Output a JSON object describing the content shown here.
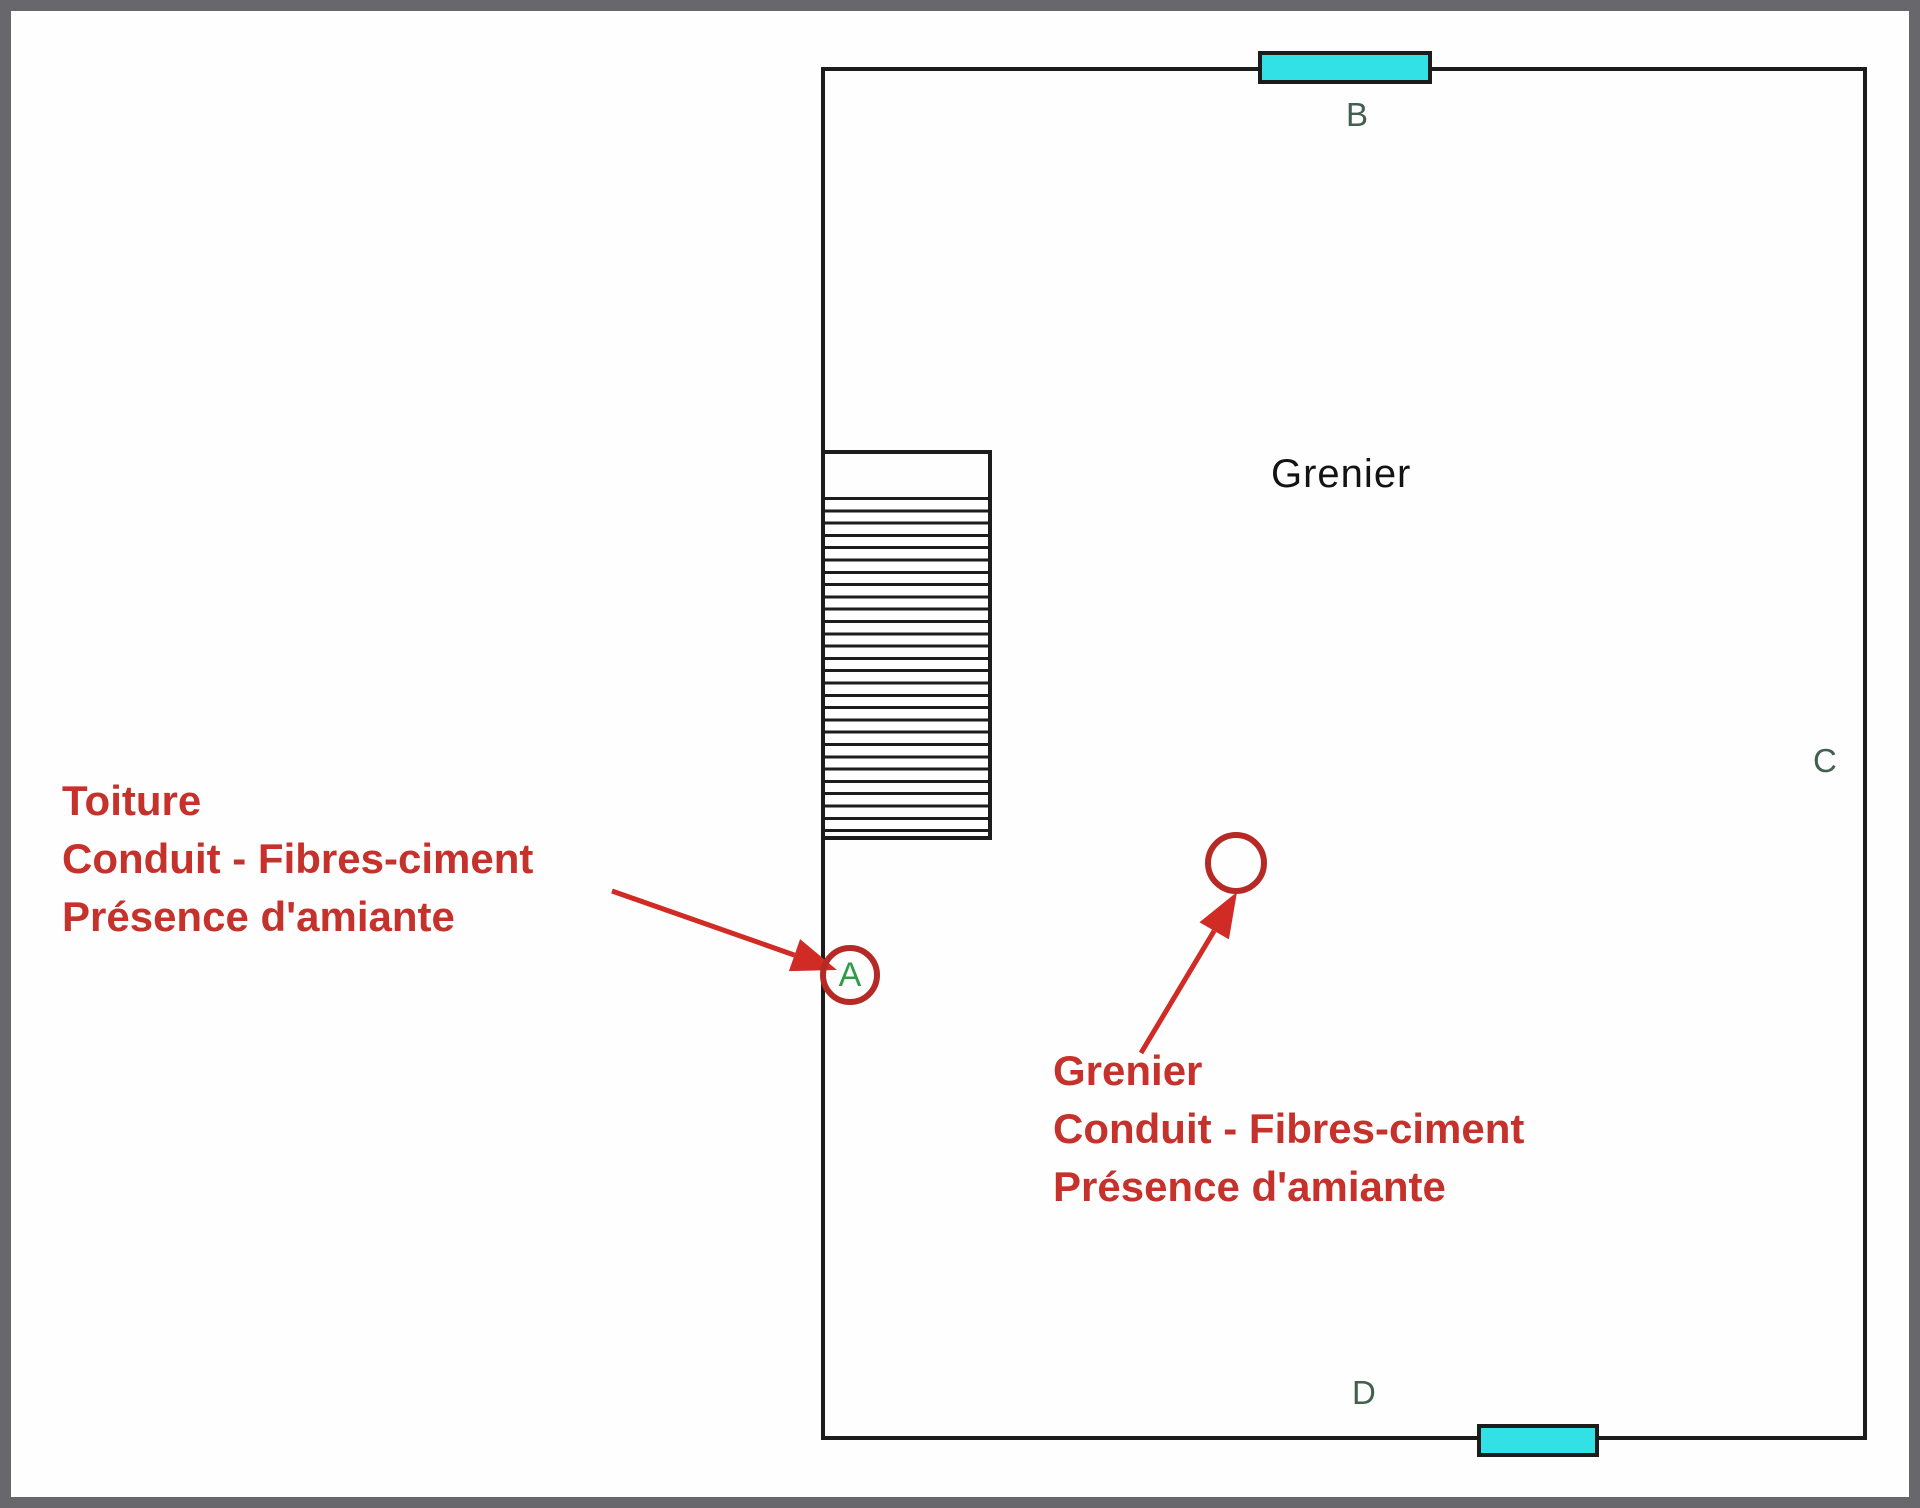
{
  "colors": {
    "frame": "#67676c",
    "canvas": "#fefefe",
    "wall": "#1c1c1c",
    "window_fill": "#31e1e6",
    "marker_green_dark": "#41604f",
    "marker_green_bright": "#2e9c49",
    "annotation_red": "#c5312b",
    "arrow_red": "#d02b24",
    "circle_red": "#b52a25",
    "room_label_black": "#131313"
  },
  "room": {
    "label": "Grenier"
  },
  "markers": {
    "a": "A",
    "b": "B",
    "c": "C",
    "d": "D"
  },
  "annotations": {
    "toiture": {
      "line1": "Toiture",
      "line2": "Conduit - Fibres-ciment",
      "line3": "Présence d'amiante"
    },
    "grenier": {
      "line1": "Grenier",
      "line2": "Conduit - Fibres-ciment",
      "line3": "Présence d'amiante"
    }
  }
}
